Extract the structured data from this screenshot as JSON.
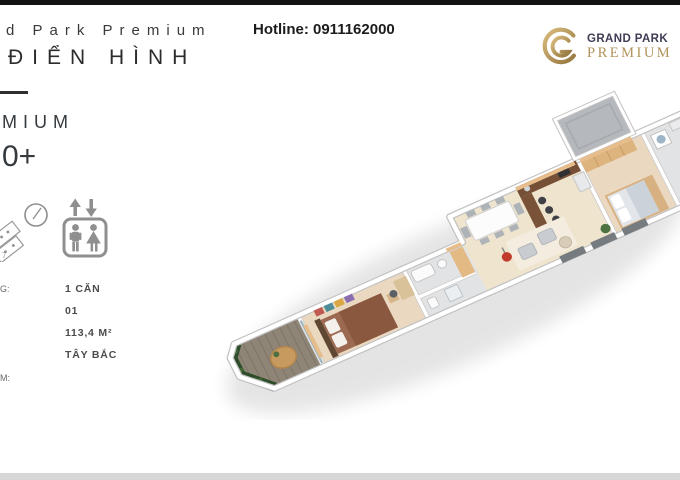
{
  "header": {
    "brand_cut": "d Park Premium",
    "subtitle_cut": "ĐIỂN HÌNH",
    "hotline": "Hotline: 0911162000"
  },
  "logo": {
    "name_top": "GRAND PARK",
    "name_bottom": "PREMIUM",
    "monogram": "G"
  },
  "left_panel": {
    "cut_word": "MIUM",
    "cut_number": "0+",
    "unit_marker": "7",
    "specs": [
      {
        "label_fragment": "G:",
        "value": "1 CĂN"
      },
      {
        "label_fragment": "",
        "value": "01"
      },
      {
        "label_fragment": "",
        "value": "113,4 M²"
      },
      {
        "label_fragment": "",
        "value": "TÂY BẮC"
      }
    ],
    "bottom_label_fragment": "M:"
  },
  "icons": [
    {
      "name": "unit-position-diagram-icon"
    },
    {
      "name": "compass-icon"
    },
    {
      "name": "elevator-icon"
    },
    {
      "name": "grand-park-monogram-icon"
    }
  ],
  "colors": {
    "gold": "#b2935b",
    "navy": "#403c55",
    "text_dark": "#2c2c2c",
    "top_bar": "#121212",
    "bottom_bar": "#d7d7d7",
    "wood_floor": "#ead9c0",
    "deck": "#8f8577",
    "green_wall": "#2f4d2a",
    "wall_accent": "#e6bd8b",
    "skylight_gray": "#b5b9be"
  }
}
